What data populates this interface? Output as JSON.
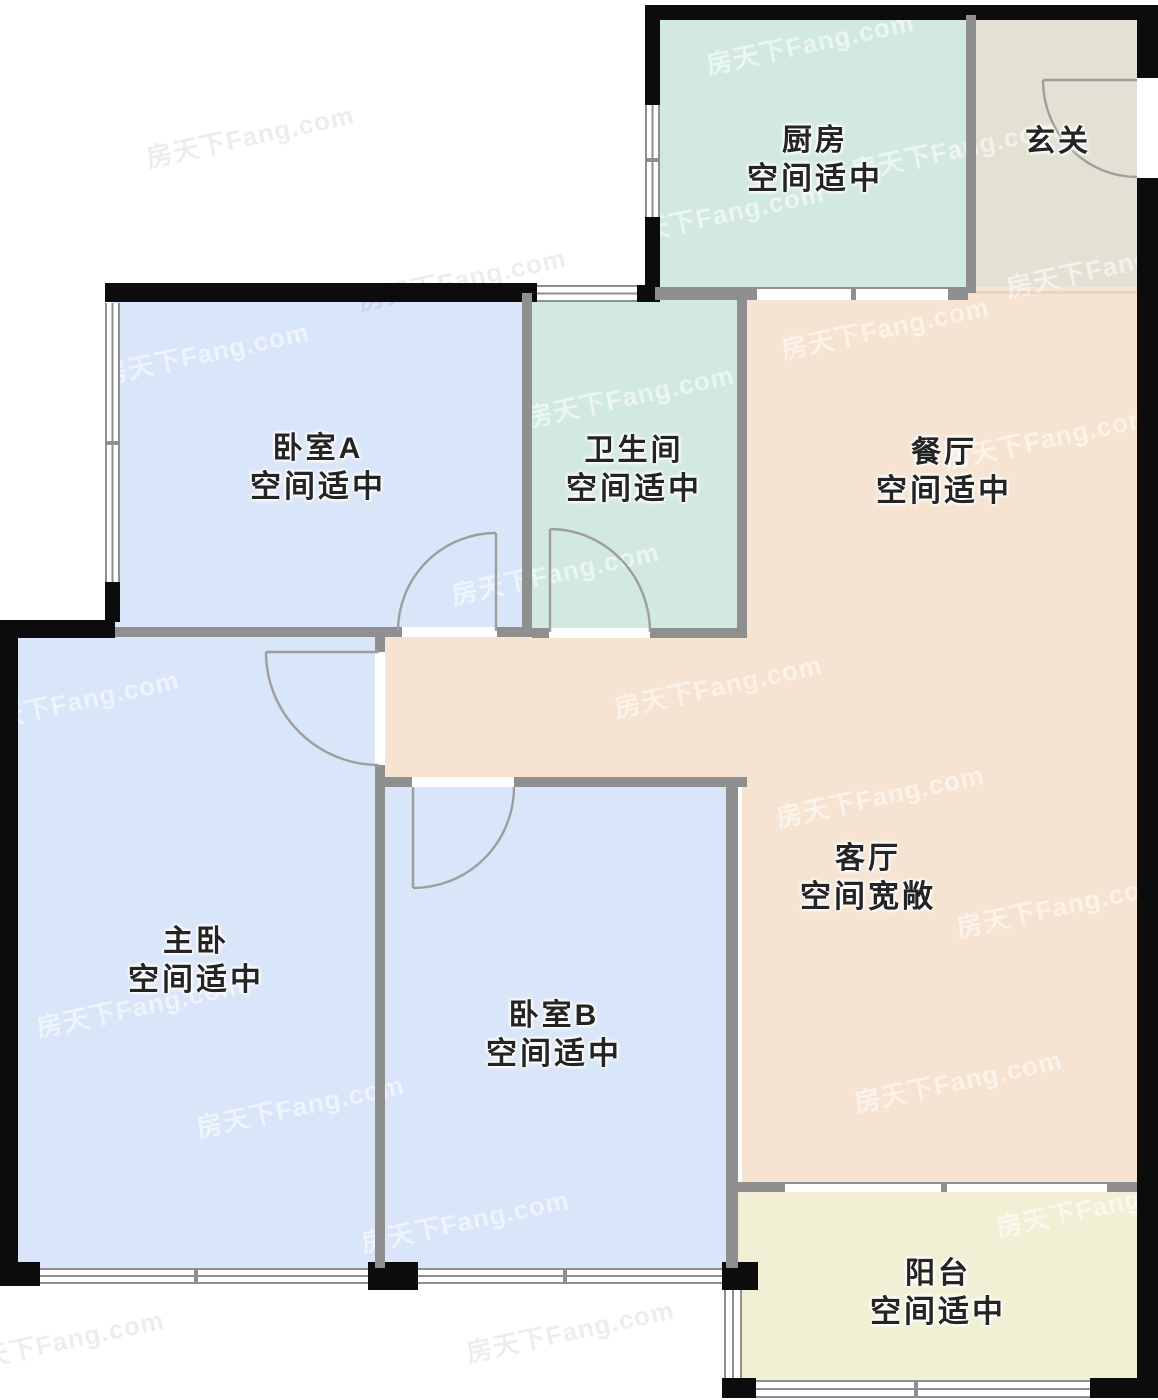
{
  "plan_source_watermark": {
    "text": "房天下Fang.com",
    "light_color": "rgba(255,255,255,0.55)",
    "dark_color": "rgba(0,0,0,0.07)",
    "positions": [
      {
        "x": 810,
        "y": 42,
        "tone": "light"
      },
      {
        "x": 955,
        "y": 148,
        "tone": "light"
      },
      {
        "x": 720,
        "y": 213,
        "tone": "light"
      },
      {
        "x": 1110,
        "y": 265,
        "tone": "light"
      },
      {
        "x": 250,
        "y": 135,
        "tone": "dark"
      },
      {
        "x": 462,
        "y": 278,
        "tone": "dark"
      },
      {
        "x": 205,
        "y": 352,
        "tone": "light"
      },
      {
        "x": 885,
        "y": 327,
        "tone": "light"
      },
      {
        "x": 630,
        "y": 395,
        "tone": "light"
      },
      {
        "x": 1048,
        "y": 437,
        "tone": "light"
      },
      {
        "x": 555,
        "y": 572,
        "tone": "light"
      },
      {
        "x": 75,
        "y": 700,
        "tone": "light"
      },
      {
        "x": 718,
        "y": 685,
        "tone": "light"
      },
      {
        "x": 880,
        "y": 795,
        "tone": "light"
      },
      {
        "x": 1060,
        "y": 905,
        "tone": "light"
      },
      {
        "x": 140,
        "y": 1005,
        "tone": "light"
      },
      {
        "x": 958,
        "y": 1080,
        "tone": "light"
      },
      {
        "x": 300,
        "y": 1105,
        "tone": "light"
      },
      {
        "x": 1100,
        "y": 1205,
        "tone": "light"
      },
      {
        "x": 465,
        "y": 1220,
        "tone": "light"
      },
      {
        "x": 570,
        "y": 1330,
        "tone": "dark"
      },
      {
        "x": 60,
        "y": 1340,
        "tone": "dark"
      }
    ]
  },
  "colors": {
    "c-bedroom": "#d9e5f8",
    "c-wet": "#d2e9e0",
    "c-tan": "#f6e3d1",
    "c-entry": "#e3e1d3",
    "c-balcony": "#f1f0d5",
    "wall-dark": "#0c0c0c",
    "wall-gray": "#8f8f8f",
    "door-line": "#9e9e9e",
    "label-text": "#242424",
    "wm-light": "rgba(255,255,255,0.55)",
    "wm-dark": "rgba(0,0,0,0.07)"
  },
  "rooms": {
    "kitchen": {
      "name": "厨房",
      "quality": "空间适中"
    },
    "entry": {
      "name": "玄关",
      "quality": ""
    },
    "bedroomA": {
      "name": "卧室A",
      "quality": "空间适中"
    },
    "bathroom": {
      "name": "卫生间",
      "quality": "空间适中"
    },
    "dining": {
      "name": "餐厅",
      "quality": "空间适中"
    },
    "master": {
      "name": "主卧",
      "quality": "空间适中"
    },
    "bedroomB": {
      "name": "卧室B",
      "quality": "空间适中"
    },
    "living": {
      "name": "客厅",
      "quality": "空间宽敞"
    },
    "balcony": {
      "name": "阳台",
      "quality": "空间适中"
    }
  }
}
